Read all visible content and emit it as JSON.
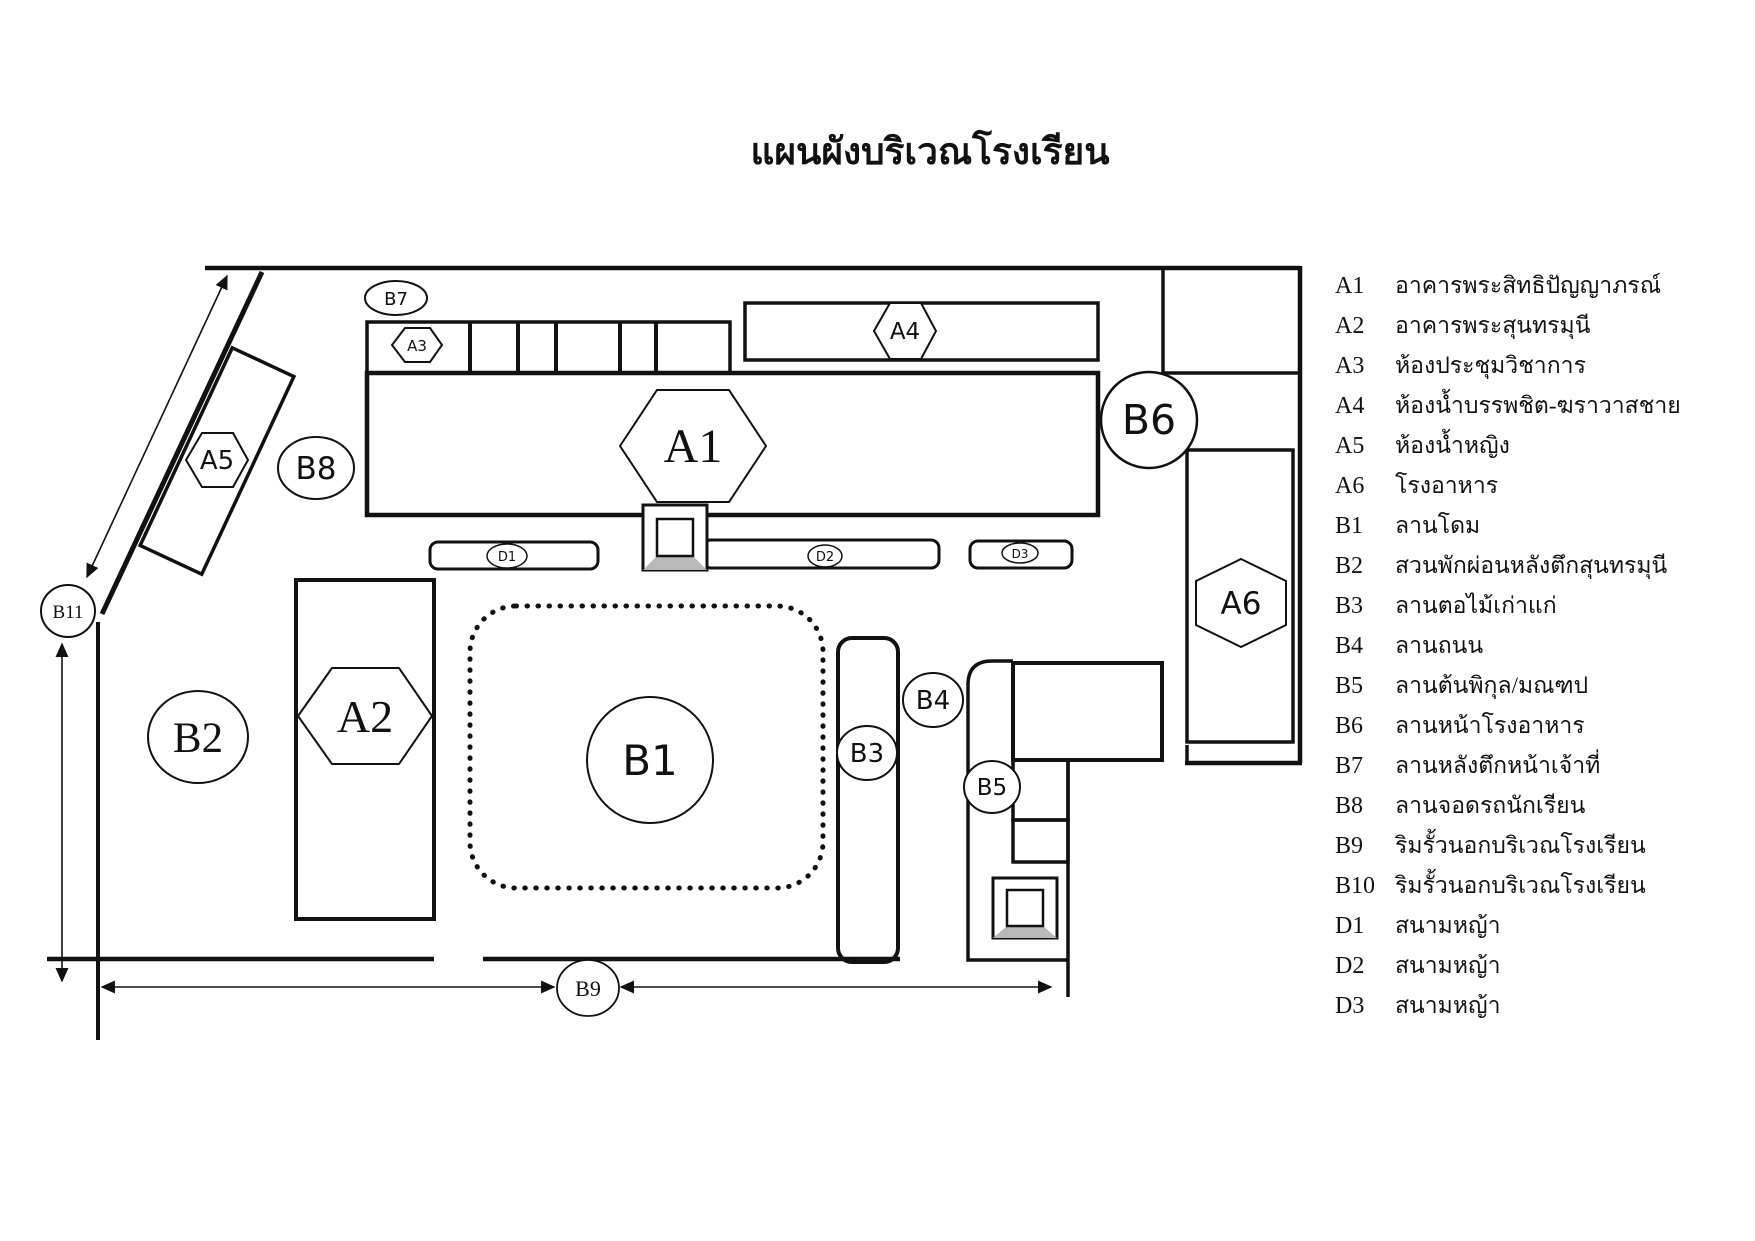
{
  "title": "แผนผังบริเวณโรงเรียน",
  "colors": {
    "line": "#111111",
    "background": "#ffffff",
    "bevel_gray": "#b9b9b9"
  },
  "map": {
    "badges": {
      "a1": "A1",
      "a2": "A2",
      "a3": "A3",
      "a4": "A4",
      "a5": "A5",
      "a6": "A6",
      "b1": "B1",
      "b2": "B2",
      "b3": "B3",
      "b4": "B4",
      "b5": "B5",
      "b6": "B6",
      "b7": "B7",
      "b8": "B8",
      "b9": "B9",
      "b11": "B11",
      "d1": "D1",
      "d2": "D2",
      "d3": "D3"
    }
  },
  "legend": {
    "items": [
      {
        "code": "A1",
        "label": "อาคารพระสิทธิปัญญาภรณ์"
      },
      {
        "code": "A2",
        "label": "อาคารพระสุนทรมุนี"
      },
      {
        "code": "A3",
        "label": "ห้องประชุมวิชาการ"
      },
      {
        "code": "A4",
        "label": "ห้องน้ำบรรพชิต-ฆราวาสชาย"
      },
      {
        "code": "A5",
        "label": "ห้องน้ำหญิง"
      },
      {
        "code": "A6",
        "label": "โรงอาหาร"
      },
      {
        "code": "B1",
        "label": "ลานโดม"
      },
      {
        "code": "B2",
        "label": "สวนพักผ่อนหลังตึกสุนทรมุนี"
      },
      {
        "code": "B3",
        "label": "ลานตอไม้เก่าแก่"
      },
      {
        "code": "B4",
        "label": "ลานถนน"
      },
      {
        "code": "B5",
        "label": "ลานต้นพิกุล/มณฑป"
      },
      {
        "code": "B6",
        "label": "ลานหน้าโรงอาหาร"
      },
      {
        "code": "B7",
        "label": "ลานหลังตึกหน้าเจ้าที่"
      },
      {
        "code": "B8",
        "label": "ลานจอดรถนักเรียน"
      },
      {
        "code": "B9",
        "label": "ริมรั้วนอกบริเวณโรงเรียน"
      },
      {
        "code": "B10",
        "label": "ริมรั้วนอกบริเวณโรงเรียน"
      },
      {
        "code": "D1",
        "label": "สนามหญ้า"
      },
      {
        "code": "D2",
        "label": "สนามหญ้า"
      },
      {
        "code": "D3",
        "label": "สนามหญ้า"
      }
    ]
  }
}
